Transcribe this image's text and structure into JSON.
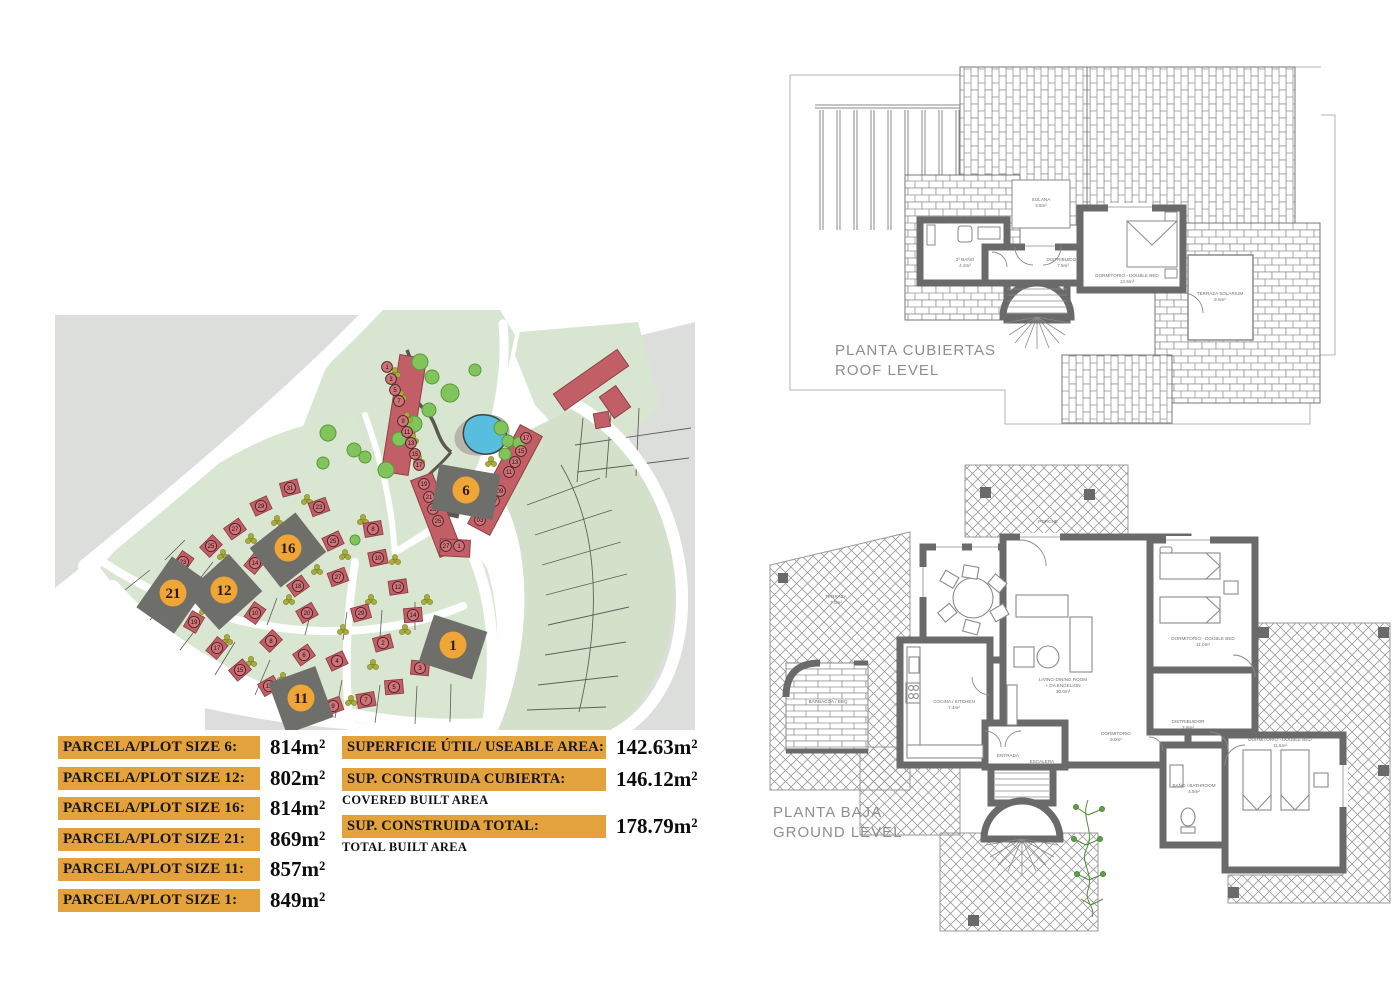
{
  "plot_table": {
    "rows": [
      {
        "label": "PARCELA/PLOT SIZE 6:",
        "value": "814m²"
      },
      {
        "label": "PARCELA/PLOT SIZE 12:",
        "value": "802m²"
      },
      {
        "label": "PARCELA/PLOT SIZE 16:",
        "value": "814m²"
      },
      {
        "label": "PARCELA/PLOT SIZE 21:",
        "value": "869m²"
      },
      {
        "label": "PARCELA/PLOT SIZE 11:",
        "value": "857m²"
      },
      {
        "label": "PARCELA/PLOT SIZE 1:",
        "value": "849m²"
      }
    ]
  },
  "area_table": {
    "rows": [
      {
        "label": "SUPERFICIE ÚTIL/ USEABLE AREA:",
        "sublabel": "",
        "value": "142.63m²"
      },
      {
        "label": "SUP. CONSTRUIDA CUBIERTA:",
        "sublabel": "COVERED BUILT AREA",
        "value": "146.12m²"
      },
      {
        "label": "SUP. CONSTRUIDA TOTAL:",
        "sublabel": "TOTAL BUILT AREA",
        "value": "178.79m²"
      }
    ]
  },
  "roof_plan": {
    "title_line1": "PLANTA CUBIERTAS",
    "title_line2": "ROOF LEVEL",
    "labels": [
      {
        "t": "SOLANA",
        "x": 266,
        "y": 146
      },
      {
        "t": "3.5m²",
        "x": 266,
        "y": 152
      },
      {
        "t": "2º BAÑO",
        "x": 190,
        "y": 206
      },
      {
        "t": "4.2m²",
        "x": 190,
        "y": 212
      },
      {
        "t": "DISTRIBUIDOR",
        "x": 288,
        "y": 206
      },
      {
        "t": "7.5m²",
        "x": 288,
        "y": 212
      },
      {
        "t": "DORMITORIO - DOUBLE BED",
        "x": 352,
        "y": 222
      },
      {
        "t": "13.5m²",
        "x": 352,
        "y": 228
      },
      {
        "t": "TERRAZA SOLARIUM",
        "x": 445,
        "y": 240
      },
      {
        "t": "9.5m²",
        "x": 445,
        "y": 246
      }
    ]
  },
  "ground_plan": {
    "title_line1": "PLANTA BAJA",
    "title_line2": "GROUND LEVEL",
    "labels": [
      {
        "t": "TERRAZA",
        "x": 78,
        "y": 163
      },
      {
        "t": "7.0m²",
        "x": 78,
        "y": 169
      },
      {
        "t": "PORCHE",
        "x": 290,
        "y": 88
      },
      {
        "t": "LIVING-DINING ROOM",
        "x": 305,
        "y": 246
      },
      {
        "t": "+ DA ENGELION",
        "x": 305,
        "y": 252
      },
      {
        "t": "30.0m²",
        "x": 305,
        "y": 258
      },
      {
        "t": "COCINA / KITCHEN",
        "x": 196,
        "y": 268
      },
      {
        "t": "7.4m²",
        "x": 196,
        "y": 274
      },
      {
        "t": "BARBACOA / BBQ",
        "x": 70,
        "y": 268
      },
      {
        "t": "DORMITORIO - DOUBLE BED",
        "x": 445,
        "y": 205
      },
      {
        "t": "11.0m²",
        "x": 445,
        "y": 211
      },
      {
        "t": "DISTRIBUIDOR",
        "x": 430,
        "y": 288
      },
      {
        "t": "2.8m²",
        "x": 430,
        "y": 294
      },
      {
        "t": "DORMITORIO",
        "x": 358,
        "y": 300
      },
      {
        "t": "9.0m²",
        "x": 358,
        "y": 306
      },
      {
        "t": "BAÑO / BATHROOM",
        "x": 436,
        "y": 352
      },
      {
        "t": "4.5m²",
        "x": 436,
        "y": 358
      },
      {
        "t": "DORMITORIO - DOUBLE BED",
        "x": 522,
        "y": 306
      },
      {
        "t": "11.5m²",
        "x": 522,
        "y": 312
      },
      {
        "t": "ENTRADA",
        "x": 250,
        "y": 322
      },
      {
        "t": "ESCALERA",
        "x": 284,
        "y": 328
      },
      {
        "t": "4.0m²",
        "x": 284,
        "y": 334
      }
    ]
  },
  "site_plan": {
    "colors": {
      "green": "#d8e5d1",
      "green_band": "#d3e1ca",
      "gray": "#dcdedb",
      "house_red": "#c25f66",
      "house_stroke": "#8f3f47",
      "marker_orange": "#F0A636",
      "plot_dark": "#6e6f6b",
      "pool_blue": "#57bedd",
      "tree_green": "#82c45c"
    },
    "big_markers": [
      {
        "n": "6",
        "x": 411,
        "y": 182,
        "w": 62,
        "h": 46,
        "rot": 10
      },
      {
        "n": "16",
        "x": 233,
        "y": 240,
        "w": 58,
        "h": 50,
        "rot": -38
      },
      {
        "n": "12",
        "x": 169,
        "y": 282,
        "w": 58,
        "h": 50,
        "rot": -42
      },
      {
        "n": "21",
        "x": 118,
        "y": 285,
        "w": 62,
        "h": 46,
        "rot": -55
      },
      {
        "n": "11",
        "x": 246,
        "y": 390,
        "w": 50,
        "h": 54,
        "rot": -20
      },
      {
        "n": "1",
        "x": 398,
        "y": 337,
        "w": 56,
        "h": 50,
        "rot": 18
      }
    ],
    "fan_houses": [
      [
        235,
        178,
        "31",
        -15
      ],
      [
        206,
        196,
        "29",
        -25
      ],
      [
        180,
        219,
        "27",
        -35
      ],
      [
        156,
        236,
        "25",
        -45
      ],
      [
        128,
        252,
        "23",
        -55
      ],
      [
        139,
        312,
        "19",
        -60
      ],
      [
        162,
        338,
        "17",
        -50
      ],
      [
        185,
        360,
        "15",
        -40
      ],
      [
        214,
        376,
        "13",
        -30
      ],
      [
        200,
        253,
        "14",
        -50
      ],
      [
        243,
        276,
        "18",
        -35
      ],
      [
        200,
        303,
        "10",
        -55
      ],
      [
        252,
        303,
        "20",
        -30
      ],
      [
        216,
        331,
        "8",
        -45
      ],
      [
        249,
        345,
        "6",
        -35
      ],
      [
        282,
        351,
        "4",
        -25
      ],
      [
        264,
        197,
        "23",
        -20
      ],
      [
        278,
        231,
        "25",
        -25
      ],
      [
        283,
        267,
        "27",
        -20
      ],
      [
        318,
        219,
        "8",
        -10
      ],
      [
        323,
        248,
        "10",
        -12
      ],
      [
        306,
        303,
        "29",
        -15
      ],
      [
        343,
        277,
        "12",
        -8
      ],
      [
        358,
        305,
        "14",
        -5
      ],
      [
        328,
        333,
        "2",
        -15
      ],
      [
        365,
        358,
        "3",
        5
      ],
      [
        339,
        377,
        "5",
        -5
      ],
      [
        311,
        390,
        "7",
        -10
      ],
      [
        278,
        396,
        "9",
        -20
      ]
    ],
    "strip_markers": [
      [
        332,
        57,
        "1"
      ],
      [
        336,
        69,
        "3"
      ],
      [
        340,
        80,
        "5"
      ],
      [
        344,
        91,
        "7"
      ],
      [
        348,
        111,
        "9"
      ],
      [
        352,
        122,
        "11"
      ],
      [
        356,
        133,
        "13"
      ],
      [
        360,
        144,
        "15"
      ],
      [
        364,
        155,
        "17"
      ],
      [
        471,
        128,
        "17"
      ],
      [
        466,
        141,
        "15"
      ],
      [
        460,
        152,
        "13"
      ],
      [
        454,
        162,
        "11"
      ],
      [
        445,
        181,
        "09"
      ],
      [
        439,
        191,
        "07"
      ],
      [
        431,
        201,
        "05"
      ],
      [
        425,
        210,
        "03"
      ],
      [
        369,
        174,
        "19"
      ],
      [
        374,
        187,
        "21"
      ],
      [
        378,
        199,
        "23"
      ],
      [
        383,
        211,
        "25"
      ],
      [
        391,
        236,
        "27"
      ],
      [
        404,
        236,
        "1"
      ]
    ],
    "trees": [
      [
        365,
        52,
        8
      ],
      [
        377,
        67,
        7
      ],
      [
        395,
        83,
        9
      ],
      [
        374,
        100,
        7
      ],
      [
        359,
        114,
        8
      ],
      [
        344,
        129,
        7
      ],
      [
        331,
        160,
        8
      ],
      [
        310,
        147,
        6
      ],
      [
        273,
        123,
        8
      ],
      [
        299,
        140,
        7
      ],
      [
        268,
        153,
        6
      ],
      [
        446,
        118,
        7
      ],
      [
        453,
        131,
        6
      ],
      [
        464,
        133,
        6
      ],
      [
        450,
        144,
        6
      ],
      [
        420,
        60,
        6
      ],
      [
        300,
        230,
        5
      ]
    ],
    "shrubs": [
      [
        340,
        63
      ],
      [
        346,
        86
      ],
      [
        352,
        108
      ],
      [
        358,
        129
      ],
      [
        364,
        150
      ],
      [
        436,
        152
      ],
      [
        429,
        172
      ],
      [
        420,
        196
      ],
      [
        252,
        190
      ],
      [
        222,
        211
      ],
      [
        196,
        229
      ],
      [
        168,
        245
      ],
      [
        150,
        300
      ],
      [
        172,
        330
      ],
      [
        196,
        352
      ],
      [
        228,
        368
      ],
      [
        262,
        381
      ],
      [
        296,
        391
      ],
      [
        308,
        210
      ],
      [
        290,
        245
      ],
      [
        262,
        260
      ],
      [
        234,
        290
      ],
      [
        316,
        290
      ],
      [
        288,
        320
      ],
      [
        318,
        355
      ],
      [
        350,
        320
      ],
      [
        372,
        290
      ],
      [
        340,
        250
      ]
    ]
  }
}
